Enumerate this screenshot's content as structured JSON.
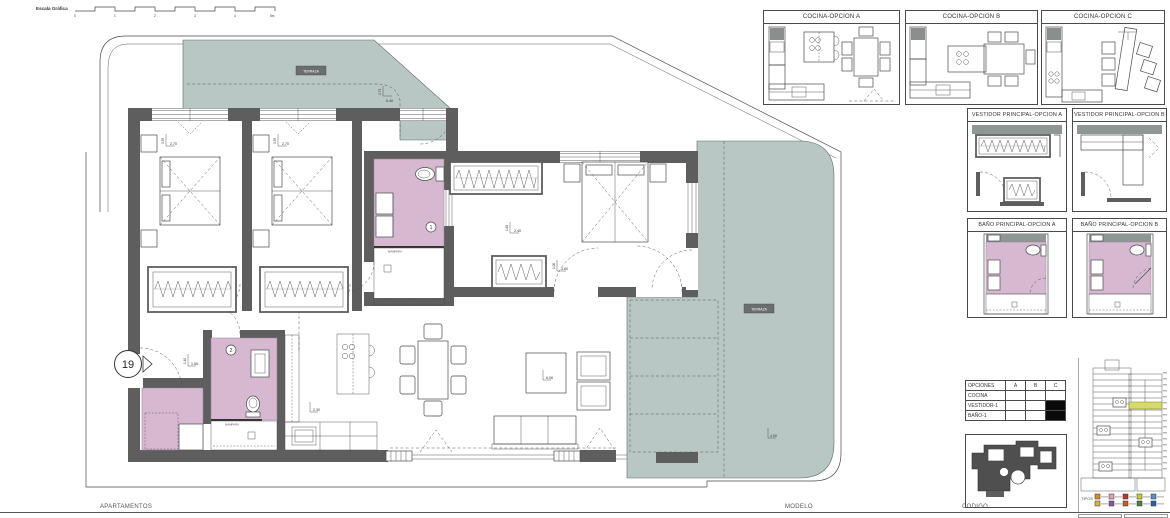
{
  "colors": {
    "terrace": "#b8c7c3",
    "bath_floor": "#d6b9d0",
    "wall": "#5e5e5e",
    "panel_band": "#8f9794",
    "highlight": "#d6db66"
  },
  "scale_bar": {
    "label": "Escala Gráfica",
    "ticks": [
      "0",
      "1",
      "2",
      "3",
      "4",
      "5m"
    ]
  },
  "plan": {
    "entry_number": "19",
    "labels": {
      "terrace_top": "TERRAZA",
      "terrace_right": "TERRAZA",
      "mampara_bath1": "MAMPARA",
      "mampara_bath2": "MAMPARA",
      "bath1_number": "1",
      "bath2_number": "2"
    },
    "dims": {
      "bed1_w": "2.70",
      "bed1_d": "3.35",
      "bed2_w": "2.70",
      "bed2_d": "3.35",
      "master_w": "2.40",
      "master_d": "1.83",
      "living_w": "3.60",
      "living_d": "1.00",
      "entry_w": "1.55",
      "entry_d": "1.40",
      "kitchen": "2.30",
      "living": "6.06",
      "terrace_right": "4.00",
      "terrace_top_d": "2.73",
      "terrace_top_w": "6.40"
    }
  },
  "panels": {
    "cocina_a": {
      "title": "COCINA-OPCION A"
    },
    "cocina_b": {
      "title": "COCINA-OPCION B"
    },
    "cocina_c": {
      "title": "COCINA-OPCION C"
    },
    "vestidor_a": {
      "title": "VESTIDOR PRINCIPAL-OPCION A"
    },
    "vestidor_b": {
      "title": "VESTIDOR PRINCIPAL-OPCION B"
    },
    "bano_a": {
      "title": "BAÑO PRINCIPAL-OPCION A"
    },
    "bano_b": {
      "title": "BAÑO PRINCIPAL-OPCION B"
    }
  },
  "options_table": {
    "headers": [
      "OPCIONES",
      "A",
      "B",
      "C"
    ],
    "rows": [
      {
        "label": "COCINA",
        "a": false,
        "b": false,
        "c": false
      },
      {
        "label": "VESTIDOR-1",
        "a": false,
        "b": false,
        "c": true
      },
      {
        "label": "BAÑO-1",
        "a": false,
        "b": false,
        "c": true
      }
    ]
  },
  "stack": {
    "tipos_label": "TIPOS",
    "highlight": "#d6db66",
    "legend_row1": [
      "#d98c2b",
      "#e2a0a8",
      "#b23a30",
      "#c3cd3a",
      "#5b8fc0"
    ],
    "legend_row2": [
      "#d9b344",
      "#7e5ea0",
      "#c06020",
      "#4a7f3f",
      "#2f5f9e"
    ]
  },
  "footer": {
    "apartments": "APARTAMENTOS",
    "model": "MODELO",
    "code": "CODIGO"
  }
}
